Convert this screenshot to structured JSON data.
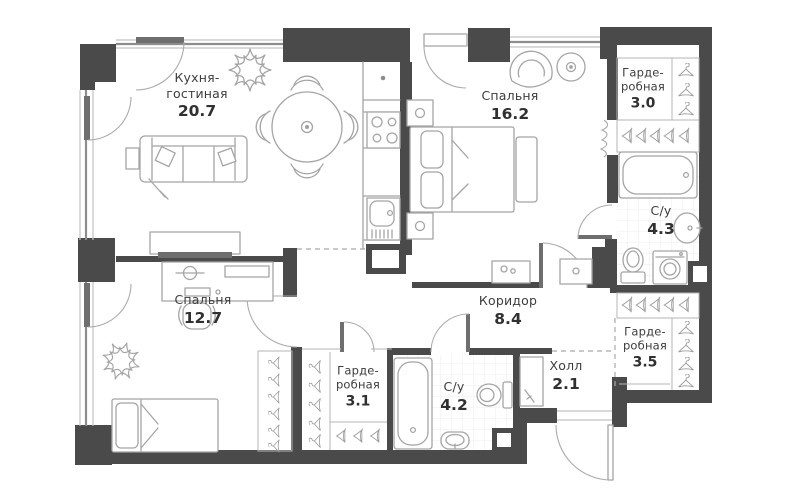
{
  "plan_title": "apartment floor plan",
  "rooms": [
    {
      "key": "kitchen-living",
      "lines": [
        "Кухня-",
        "гостиная"
      ],
      "area": "20.7"
    },
    {
      "key": "bedroom-main",
      "lines": [
        "Спальня"
      ],
      "area": "16.2"
    },
    {
      "key": "wardrobe-top",
      "lines": [
        "Гарде-",
        "робная"
      ],
      "area": "3.0"
    },
    {
      "key": "bathroom-main",
      "lines": [
        "С/у"
      ],
      "area": "4.3"
    },
    {
      "key": "corridor",
      "lines": [
        "Коридор"
      ],
      "area": "8.4"
    },
    {
      "key": "wardrobe-right",
      "lines": [
        "Гарде-",
        "робная"
      ],
      "area": "3.5"
    },
    {
      "key": "hall",
      "lines": [
        "Холл"
      ],
      "area": "2.1"
    },
    {
      "key": "bedroom-second",
      "lines": [
        "Спальня"
      ],
      "area": "12.7"
    },
    {
      "key": "wardrobe-bottom",
      "lines": [
        "Гарде-",
        "робная"
      ],
      "area": "3.1"
    },
    {
      "key": "bathroom-second",
      "lines": [
        "С/у"
      ],
      "area": "4.2"
    }
  ],
  "icons": {
    "hanger": "front-view clothes hanger",
    "hanger_side": "side-view clothes hanger"
  },
  "colors": {
    "wall": "#4a4a4a",
    "furniture_line": "#a5a5a5",
    "door_line": "#ababab",
    "text": "#3d3d3d",
    "tile_line": "#ededed",
    "background": "#ffffff"
  }
}
